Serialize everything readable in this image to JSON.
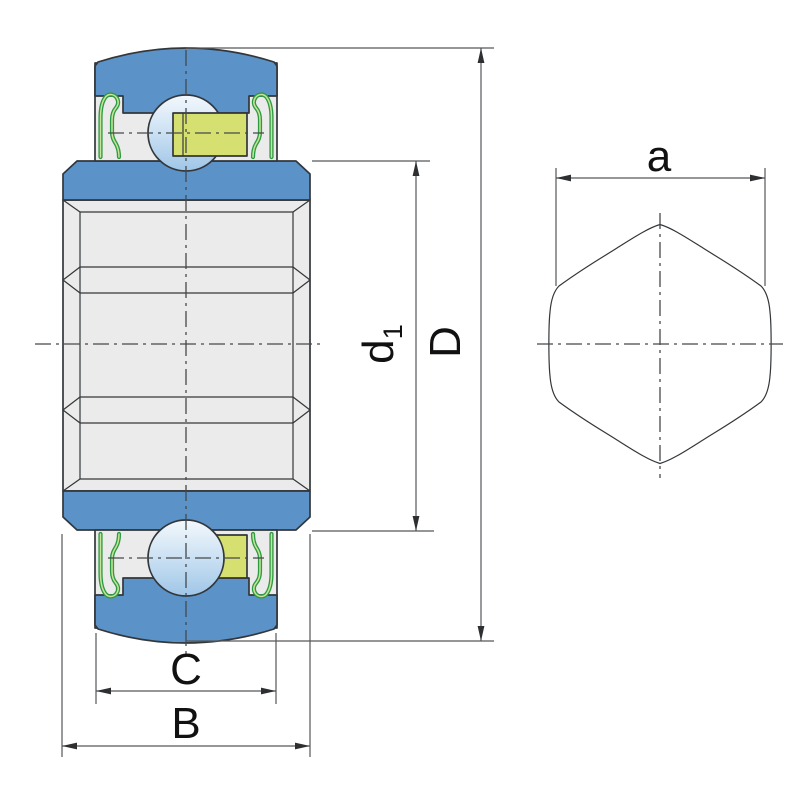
{
  "figure": {
    "type": "technical-drawing",
    "description": "Sealed insert ball bearing cross-section with spherical outer ring and hexagonal bore profile",
    "labels": {
      "outer_diameter": "D",
      "inner_ring_diameter_main": "d",
      "inner_ring_diameter_sub": "1",
      "outer_ring_width": "C",
      "total_width": "B",
      "hex_bore_width": "a"
    },
    "colors": {
      "ring_blue": "#5b92c8",
      "steel_grey": "#ebebeb",
      "cage_yellow_green": "#d6e070",
      "seal_green": "#2e9b43",
      "seal_green_light": "#c8e49a",
      "ball_light": "#f3f8fc",
      "ball_mid": "#cfe3f4",
      "ball_shade": "#9fc6e7",
      "outline": "#33373a",
      "dimension_line": "#55585a",
      "background": "#ffffff"
    }
  }
}
